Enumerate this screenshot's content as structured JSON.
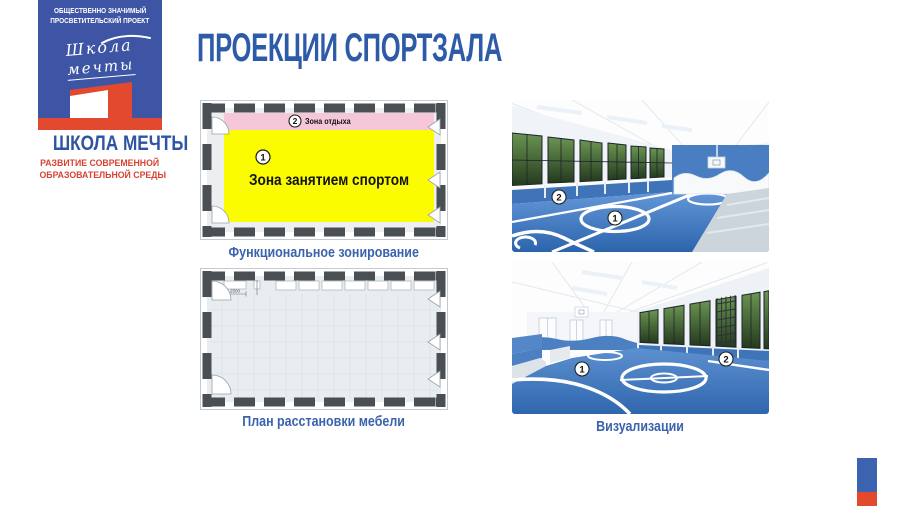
{
  "header": {
    "title": "ПРОЕКЦИИ СПОРТЗАЛА"
  },
  "logo": {
    "project_type_line1": "ОБЩЕСТВЕННО ЗНАЧИМЫЙ",
    "project_type_line2": "ПРОСВЕТИТЕЛЬСКИЙ ПРОЕКТ",
    "script_word1": "Школа",
    "script_word2": "мечты",
    "brand_name": "ШКОЛА МЕЧТЫ",
    "tagline_line1": "РАЗВИТИЕ СОВРЕМЕННОЙ",
    "tagline_line2": "ОБРАЗОВАТЕЛЬНОЙ СРЕДЫ"
  },
  "zoning_plan": {
    "caption": "Функциональное зонирование",
    "rest_zone": {
      "num": "2",
      "label": "Зона отдыха",
      "color": "#f6c6d9"
    },
    "sport_zone": {
      "num": "1",
      "label": "Зона занятием спортом",
      "color": "#fcfc00"
    }
  },
  "furniture_plan": {
    "caption": "План расстановки мебели",
    "dimension_label": "2500"
  },
  "visualizations": {
    "caption": "Визуализации",
    "image1": {
      "marker1": "1",
      "marker2": "2"
    },
    "image2": {
      "marker1": "1",
      "marker2": "2"
    }
  },
  "colors": {
    "brand_blue": "#3d55a4",
    "brand_red": "#e2492e",
    "title_blue": "#2e5ba8",
    "caption_blue": "#3b63ac",
    "plan_wall_dark": "#4a4f54",
    "gym_floor_blue": "#3a74bb"
  }
}
